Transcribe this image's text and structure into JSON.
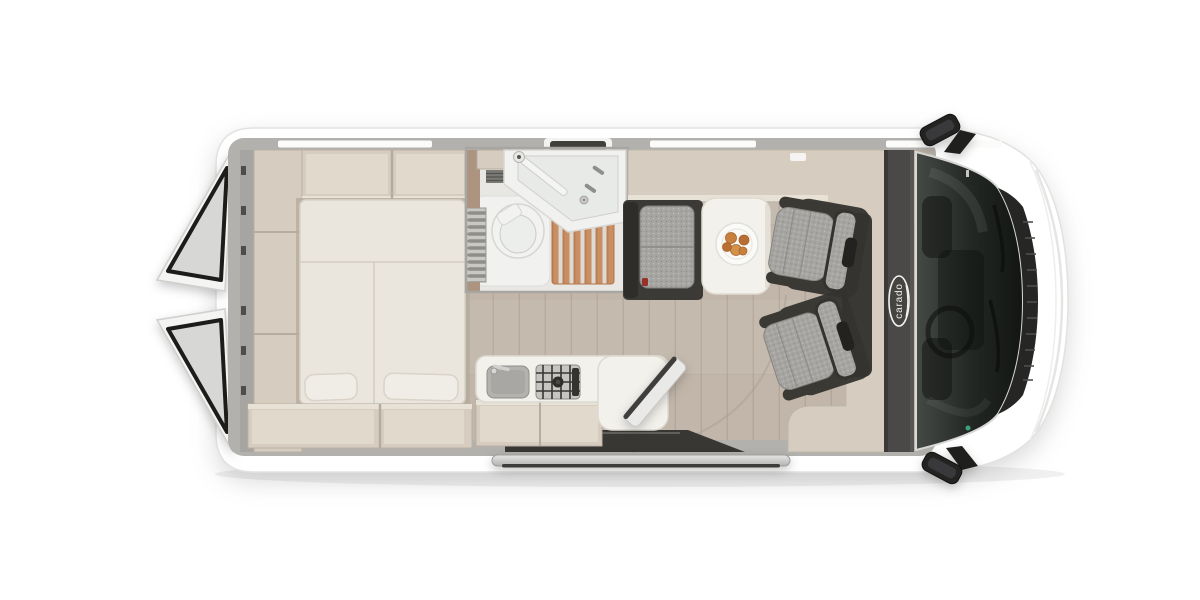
{
  "brand": {
    "logo_text": "carado"
  },
  "colors": {
    "van-outline": "#e3e2e0",
    "wall-gray": "#b3b1ad",
    "cabinet-beige": "#d6cdc0",
    "cabinet-inner": "#e1d9cc",
    "cabinet-lip": "#e8e1d5",
    "cabinet-shadow": "#b5ac9e",
    "mattress": "#eae6de",
    "mattress-seam": "#d2ccc1",
    "pillow": "#f0ede6",
    "wood-floor": "#c2b6aa",
    "wood-plank": "#b3a79b",
    "bath-floor": "#e9e7e3",
    "bath-wall-wood": "#ac9480",
    "porcelain": "#f2f3f1",
    "duckboard": "#c98f63",
    "duckboard-dark": "#b0744a",
    "gray-slat": "#8f8e8a",
    "bench-dark": "#3b3a37",
    "seat-fabric": "#a6a5a1",
    "seat-dark": "#34332f",
    "speckle-dot": "#8d8c88",
    "table-white": "#f3f1eb",
    "plate-white": "#fafaf8",
    "croissant": "#c8803d",
    "croissant-dark": "#b96f33",
    "dash-dark": "#4a4947",
    "glass-light": "#454a46",
    "glass-mid": "#242824",
    "glass-dark": "#121512",
    "grille-dark": "#262725",
    "grille-rib": "#4e4f4d",
    "hood-line": "#e6e5e3",
    "step-silver": "#d9d9d7",
    "step-dark": "#3c3c3a",
    "mirror-black": "#232321",
    "door-white": "#f4f4f2",
    "door-frame": "#1c1c1b",
    "belt-red": "#96322b",
    "accent-green": "#3fae8c"
  }
}
